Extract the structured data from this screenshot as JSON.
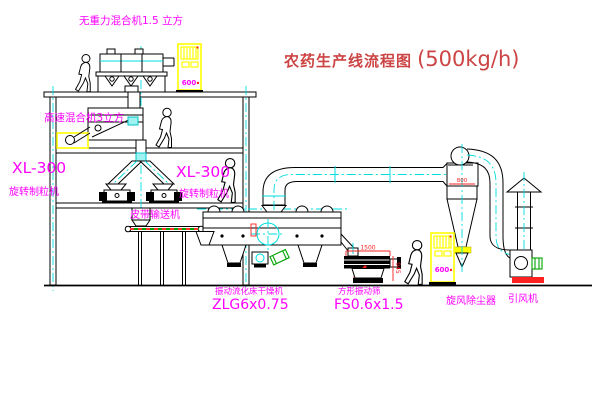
{
  "title": {
    "name": "农药生产线流程图",
    "capacity": "(500kg/h)"
  },
  "labels": {
    "gravity_mixer": "无重力混合机1.5 立方",
    "high_speed_mixer": "高速混合机3立方",
    "granulator_left_model": "XL-300",
    "granulator_left_name": "旋转制粒机",
    "granulator_right_model": "XL-300",
    "granulator_right_name": "旋转制粒机",
    "belt_conveyor": "皮带输送机",
    "dryer_name": "振动流化床干燥机",
    "dryer_model": "ZLG6x0.75",
    "sieve_name": "方形振动筛",
    "sieve_model": "FS0.6x1.5",
    "cyclone": "旋风除尘器",
    "fan": "引风机"
  },
  "dims": {
    "sieve_length": "1500",
    "sieve_height": "945",
    "cyclone_inlet": "800"
  },
  "cabinet": {
    "panel_text": "600"
  },
  "colors": {
    "label_magenta": "#ff00ff",
    "line_black": "#000000",
    "centerline_cyan": "#00dede",
    "cabinet_yellow": "#ffff00",
    "dimension_red": "#ff2020",
    "title_red": "#cc4444",
    "motor_green": "#00a400"
  }
}
